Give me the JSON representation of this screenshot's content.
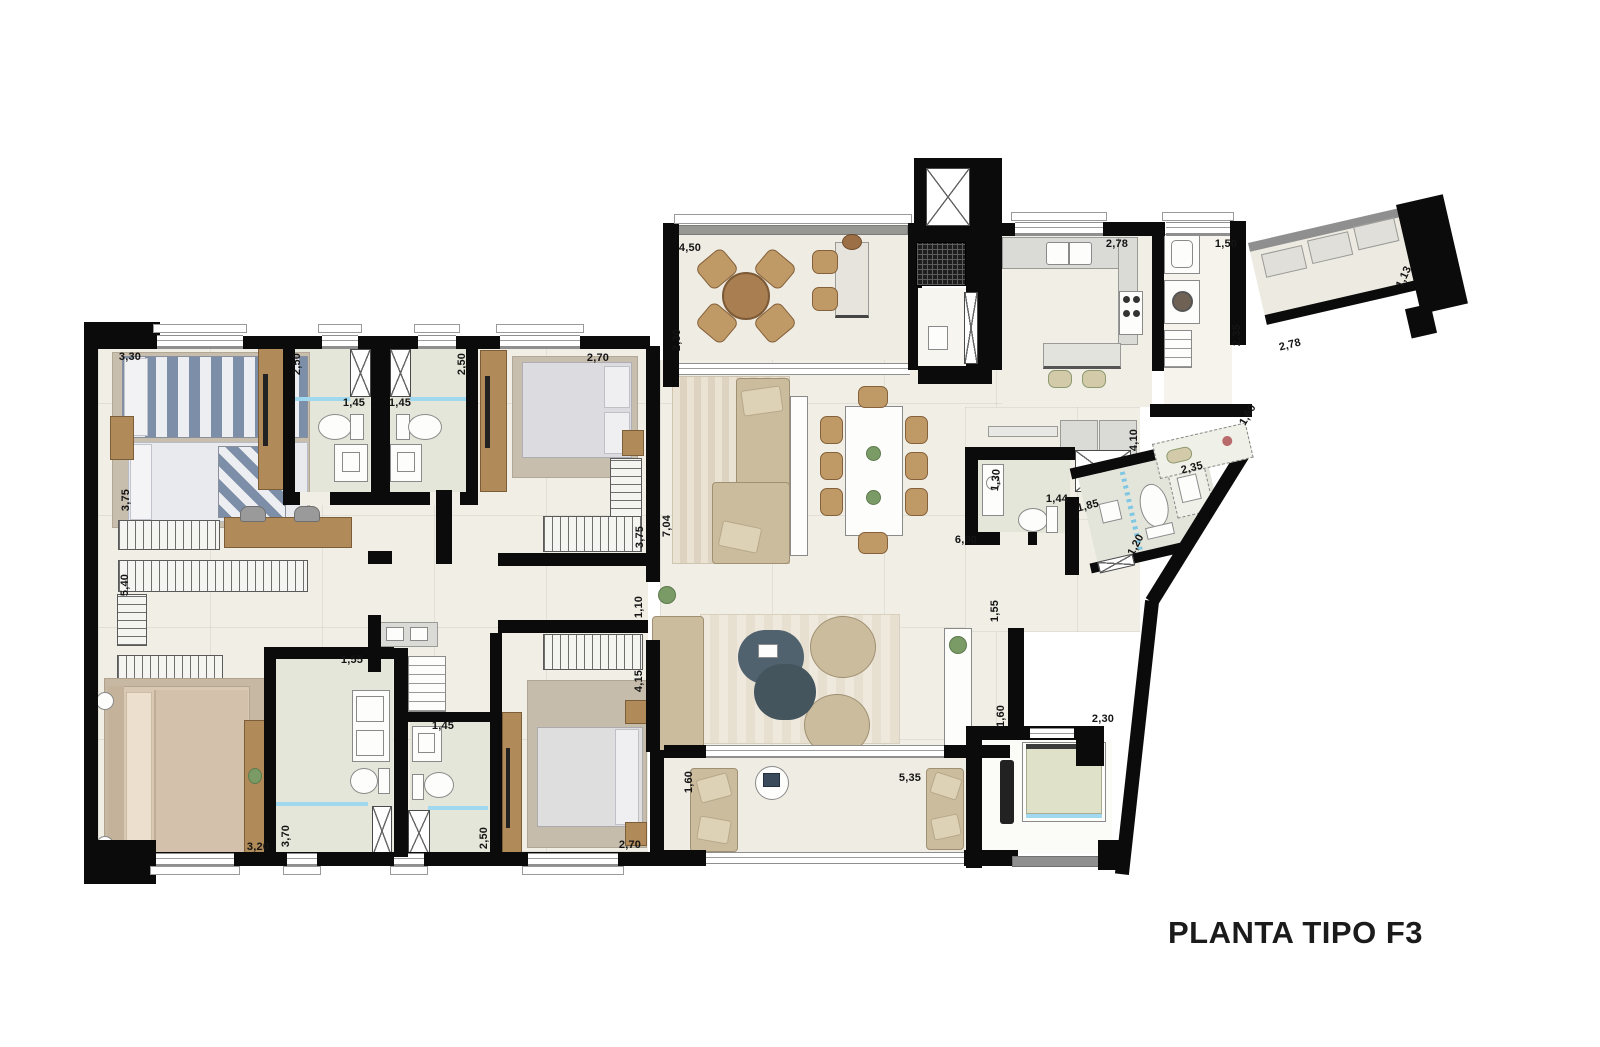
{
  "title": "PLANTA TIPO F3",
  "colors": {
    "wall": "#0b0b0b",
    "floor": "#f1eee6",
    "bath_floor": "#e4e6da",
    "glass_accent": "#9fd8ef",
    "wood": "#b08a58",
    "fabric": "#cbbc9d",
    "coffee_table": "#4e5d6b"
  },
  "labels": [
    {
      "t": "3,30",
      "x": 130,
      "y": 357,
      "r": 0
    },
    {
      "t": "3,75",
      "x": 126,
      "y": 500,
      "r": -90
    },
    {
      "t": "2,50",
      "x": 297,
      "y": 364,
      "r": -90
    },
    {
      "t": "1,45",
      "x": 354,
      "y": 403,
      "r": 0
    },
    {
      "t": "1,45",
      "x": 400,
      "y": 403,
      "r": 0
    },
    {
      "t": "2,50",
      "x": 462,
      "y": 364,
      "r": -90
    },
    {
      "t": "2,70",
      "x": 598,
      "y": 358,
      "r": 0
    },
    {
      "t": "5,40",
      "x": 125,
      "y": 585,
      "r": -90
    },
    {
      "t": "4,50",
      "x": 690,
      "y": 248,
      "r": 0
    },
    {
      "t": "2,30",
      "x": 677,
      "y": 340,
      "r": -90
    },
    {
      "t": "2,78",
      "x": 1117,
      "y": 244,
      "r": 0
    },
    {
      "t": "1,50",
      "x": 1226,
      "y": 244,
      "r": 0
    },
    {
      "t": "2,35",
      "x": 1237,
      "y": 335,
      "r": -90
    },
    {
      "t": "1,13",
      "x": 1404,
      "y": 277,
      "r": -65
    },
    {
      "t": "2,78",
      "x": 1290,
      "y": 345,
      "r": -14
    },
    {
      "t": "1,60",
      "x": 1248,
      "y": 415,
      "r": -60
    },
    {
      "t": "2,35",
      "x": 1192,
      "y": 468,
      "r": -14
    },
    {
      "t": "4,10",
      "x": 1134,
      "y": 440,
      "r": -90
    },
    {
      "t": "1,30",
      "x": 996,
      "y": 480,
      "r": -85
    },
    {
      "t": "1,44",
      "x": 1057,
      "y": 499,
      "r": 0
    },
    {
      "t": "1,85",
      "x": 1088,
      "y": 506,
      "r": -14
    },
    {
      "t": "1,20",
      "x": 1136,
      "y": 545,
      "r": -62
    },
    {
      "t": "6,00",
      "x": 966,
      "y": 540,
      "r": 0
    },
    {
      "t": "7,04",
      "x": 667,
      "y": 526,
      "r": -90
    },
    {
      "t": "3,75",
      "x": 640,
      "y": 537,
      "r": -90
    },
    {
      "t": "1,10",
      "x": 639,
      "y": 607,
      "r": -90
    },
    {
      "t": "1,55",
      "x": 995,
      "y": 611,
      "r": -90
    },
    {
      "t": "4,15",
      "x": 639,
      "y": 681,
      "r": -90
    },
    {
      "t": "1,60",
      "x": 689,
      "y": 782,
      "r": -90
    },
    {
      "t": "5,35",
      "x": 910,
      "y": 778,
      "r": 0
    },
    {
      "t": "1,60",
      "x": 1001,
      "y": 716,
      "r": -90
    },
    {
      "t": "2,30",
      "x": 1103,
      "y": 719,
      "r": 0
    },
    {
      "t": "2,70",
      "x": 630,
      "y": 845,
      "r": 0
    },
    {
      "t": "3,70",
      "x": 286,
      "y": 836,
      "r": -90
    },
    {
      "t": "1,45",
      "x": 443,
      "y": 726,
      "r": 0
    },
    {
      "t": "2,50",
      "x": 484,
      "y": 838,
      "r": -90
    },
    {
      "t": "3,20",
      "x": 258,
      "y": 847,
      "r": 0
    },
    {
      "t": "1,55",
      "x": 352,
      "y": 660,
      "r": 0
    }
  ]
}
